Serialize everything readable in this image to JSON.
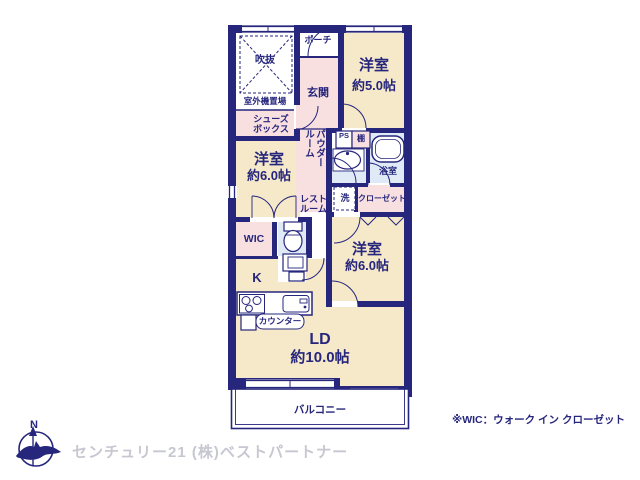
{
  "colors": {
    "wall_navy": "#26267d",
    "room_beige": "#f6e9c9",
    "hall_pink": "#f8dfe0",
    "wet_blue": "#dfeaf6",
    "watermark_gray": "#c7c7d2",
    "background": "#ffffff"
  },
  "plan": {
    "rooms": {
      "fukinuke": {
        "label": "吹抜"
      },
      "outdoor_unit": {
        "label": "室外機置場"
      },
      "shoe_box": {
        "label": "シューズボックス"
      },
      "porch": {
        "label": "ポーチ"
      },
      "entrance": {
        "label": "玄関"
      },
      "western_room_5": {
        "name": "洋室",
        "size": "約5.0帖"
      },
      "western_room_6_left": {
        "name": "洋室",
        "size": "約6.0帖"
      },
      "western_room_6_right": {
        "name": "洋室",
        "size": "約6.0帖"
      },
      "living_dining": {
        "name": "LD",
        "size": "約10.0帖"
      },
      "kitchen": {
        "label": "K"
      },
      "counter": {
        "label": "カウンター"
      },
      "powder_room": {
        "label": "パウダールーム"
      },
      "rest_room": {
        "label": "レストルーム"
      },
      "pipe_space": {
        "label": "PS"
      },
      "shelf": {
        "label": "棚"
      },
      "bathroom": {
        "label": "浴室"
      },
      "laundry": {
        "label": "洗"
      },
      "closet": {
        "label": "クローゼット"
      },
      "wic": {
        "label": "WIC"
      },
      "balcony": {
        "label": "バルコニー"
      }
    },
    "compass": {
      "label": "N"
    },
    "note": "※WIC：ウォーク イン クローゼット",
    "watermark": "センチュリー21 (株)ベストパートナー"
  }
}
